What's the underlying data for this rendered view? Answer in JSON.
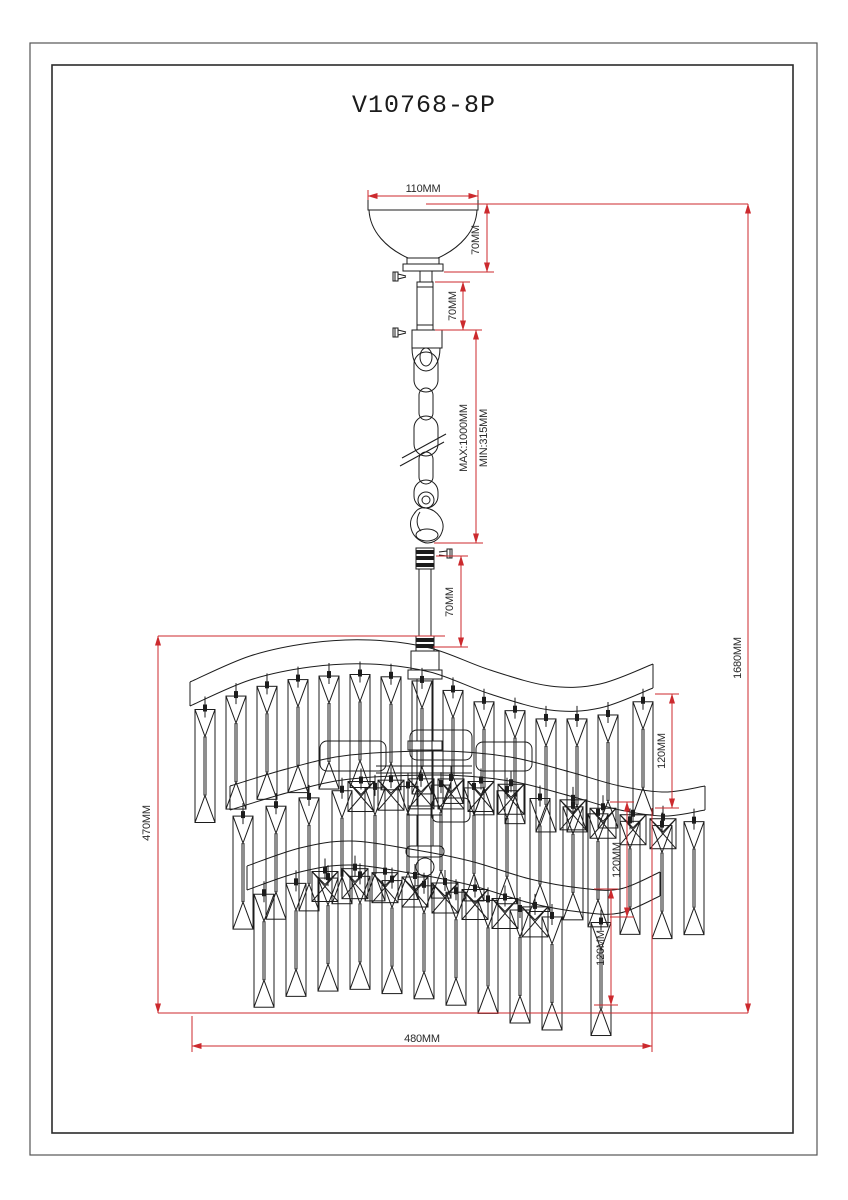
{
  "page": {
    "title": "V10768-8P"
  },
  "dimensions": {
    "canopy_width": "110MM",
    "canopy_height": "70MM",
    "upper_stem": "70MM",
    "chain_max": "MAX:1000MM",
    "chain_min": "MIN:315MM",
    "lower_stem": "70MM",
    "overall_height": "1680MM",
    "body_height": "470MM",
    "tier1_crystal": "120MM",
    "tier2_crystal": "120MM",
    "tier3_crystal": "120MM",
    "body_width": "480MM"
  },
  "colors": {
    "dimension_red": "#cc2a2e",
    "line_black": "#1c1c1c"
  }
}
